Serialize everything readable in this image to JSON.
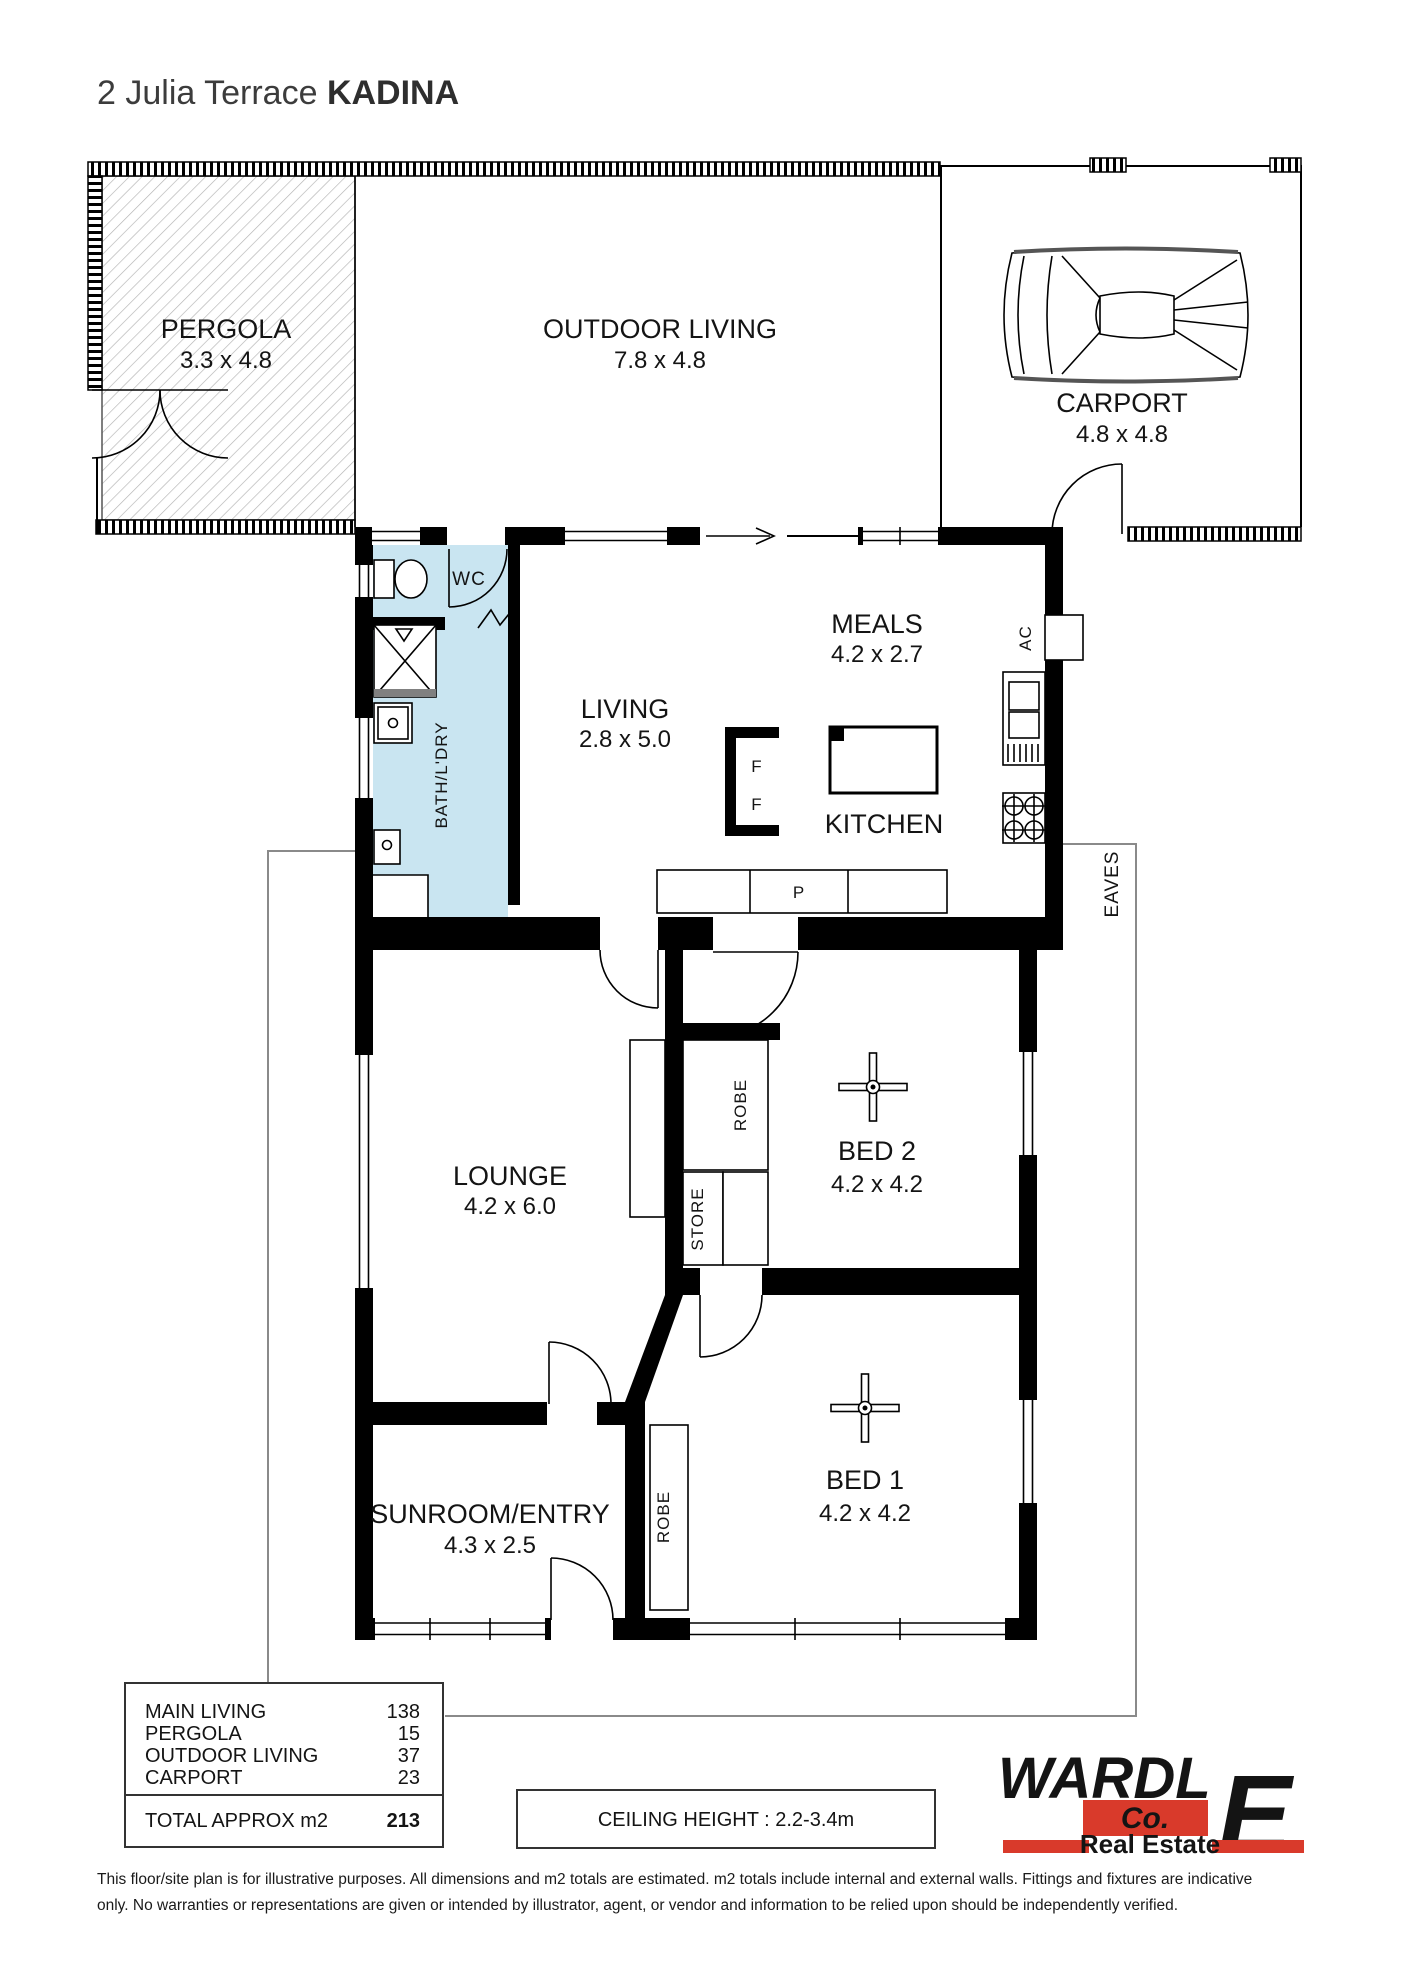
{
  "title": {
    "address": "2 Julia Terrace ",
    "suburb": "KADINA"
  },
  "rooms": {
    "pergola": {
      "name": "PERGOLA",
      "dims": "3.3 x 4.8"
    },
    "outdoor_living": {
      "name": "OUTDOOR LIVING",
      "dims": "7.8 x 4.8"
    },
    "carport": {
      "name": "CARPORT",
      "dims": "4.8 x 4.8"
    },
    "living": {
      "name": "LIVING",
      "dims": "2.8 x 5.0"
    },
    "meals": {
      "name": "MEALS",
      "dims": "4.2 x 2.7"
    },
    "kitchen": {
      "name": "KITCHEN"
    },
    "wc": {
      "name": "WC"
    },
    "bath_laundry": {
      "name": "BATH/L'DRY"
    },
    "lounge": {
      "name": "LOUNGE",
      "dims": "4.2 x 6.0"
    },
    "bed2": {
      "name": "BED 2",
      "dims": "4.2 x 4.2"
    },
    "bed1": {
      "name": "BED 1",
      "dims": "4.2 x 4.2"
    },
    "sunroom": {
      "name": "SUNROOM/ENTRY",
      "dims": "4.3 x 2.5"
    },
    "robe_bed2": {
      "name": "ROBE"
    },
    "robe_bed1": {
      "name": "ROBE"
    },
    "store": {
      "name": "STORE"
    }
  },
  "labels": {
    "eaves": "EAVES",
    "ac": "AC",
    "pantry": "P",
    "fridge_top": "F",
    "fridge_bottom": "F"
  },
  "area_table": {
    "rows": [
      {
        "label": "MAIN LIVING",
        "value": "138"
      },
      {
        "label": "PERGOLA",
        "value": "15"
      },
      {
        "label": "OUTDOOR LIVING",
        "value": "37"
      },
      {
        "label": "CARPORT",
        "value": "23"
      }
    ],
    "total_label": "TOTAL APPROX m2",
    "total_value": "213"
  },
  "ceiling_note": "CEILING HEIGHT : 2.2-3.4m",
  "logo": {
    "word_main": "WARDL",
    "word_e": "E",
    "co": "Co.",
    "tagline": "Real Estate"
  },
  "disclaimer": {
    "line1": "This floor/site plan is for illustrative purposes. All dimensions and m2 totals are estimated. m2 totals include internal and external walls. Fittings and fixtures are indicative",
    "line2": "only. No warranties or representations are given or intended by illustrator, agent, or vendor and information to be relied upon should be independently verified."
  },
  "colors": {
    "wall": "#000000",
    "bath_fill": "#c9e5f1",
    "shower_strip": "#808080",
    "logo_navy": "#253063",
    "logo_red": "#d93a2b",
    "eaves_line": "#8a8a8a"
  }
}
